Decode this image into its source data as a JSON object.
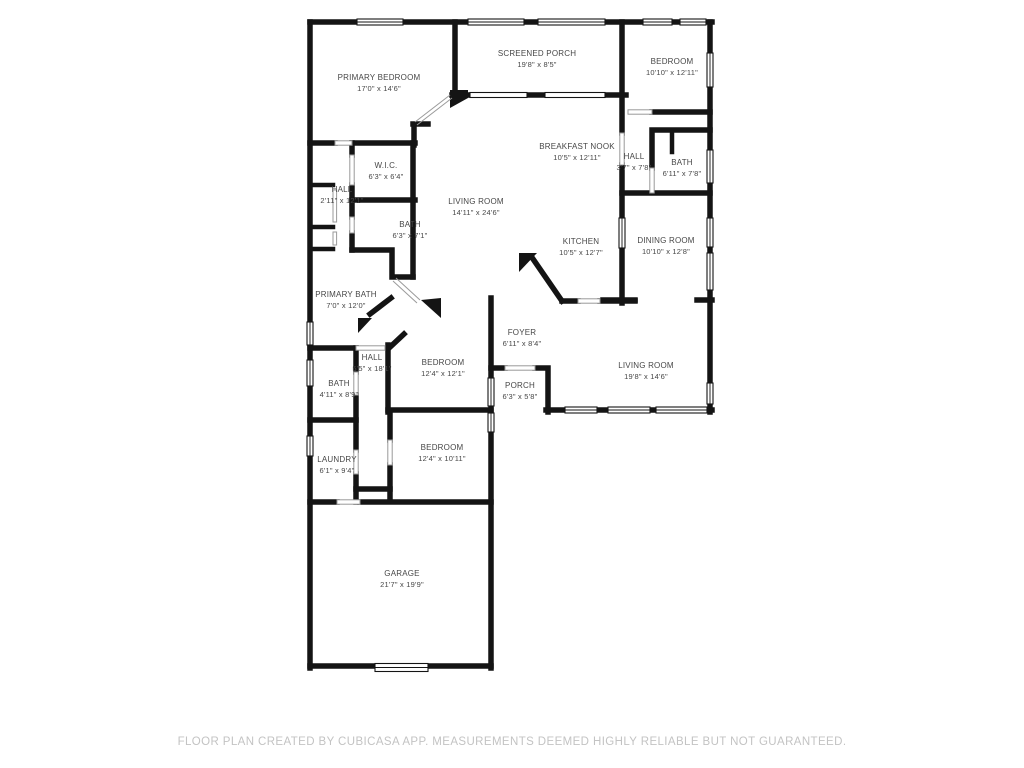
{
  "floor_plan": {
    "footer_disclaimer": "FLOOR PLAN CREATED BY CUBICASA APP. MEASUREMENTS DEEMED HIGHLY RELIABLE BUT NOT GUARANTEED.",
    "wall_color": "#141414",
    "label_color": "#474747",
    "footer_color": "#c3c3c3",
    "rooms": [
      {
        "name": "PRIMARY BEDROOM",
        "dimensions": "17'0\" x 14'6\"",
        "x": 379,
        "y": 83
      },
      {
        "name": "SCREENED PORCH",
        "dimensions": "19'8\" x 8'5\"",
        "x": 537,
        "y": 59
      },
      {
        "name": "BEDROOM",
        "dimensions": "10'10\" x 12'11\"",
        "x": 672,
        "y": 67
      },
      {
        "name": "W.I.C.",
        "dimensions": "6'3\" x 6'4\"",
        "x": 386,
        "y": 171
      },
      {
        "name": "HALL",
        "dimensions": "2'11\" x 12'1\"",
        "x": 342,
        "y": 195
      },
      {
        "name": "BREAKFAST NOOK",
        "dimensions": "10'5\" x 12'11\"",
        "x": 577,
        "y": 152
      },
      {
        "name": "HALL",
        "dimensions": "3'7\" x 7'8\"",
        "x": 634,
        "y": 162
      },
      {
        "name": "BATH",
        "dimensions": "6'11\" x 7'8\"",
        "x": 682,
        "y": 168
      },
      {
        "name": "LIVING ROOM",
        "dimensions": "14'11\" x 24'6\"",
        "x": 476,
        "y": 207
      },
      {
        "name": "BATH",
        "dimensions": "6'3\" x 7'1\"",
        "x": 410,
        "y": 230
      },
      {
        "name": "KITCHEN",
        "dimensions": "10'5\" x 12'7\"",
        "x": 581,
        "y": 247
      },
      {
        "name": "DINING ROOM",
        "dimensions": "10'10\" x 12'8\"",
        "x": 666,
        "y": 246
      },
      {
        "name": "PRIMARY BATH",
        "dimensions": "7'0\" x 12'0\"",
        "x": 346,
        "y": 300
      },
      {
        "name": "FOYER",
        "dimensions": "6'11\" x 8'4\"",
        "x": 522,
        "y": 338
      },
      {
        "name": "HALL",
        "dimensions": "5'5\" x 18'1\"",
        "x": 372,
        "y": 363
      },
      {
        "name": "BEDROOM",
        "dimensions": "12'4\" x 12'1\"",
        "x": 443,
        "y": 368
      },
      {
        "name": "LIVING ROOM",
        "dimensions": "19'8\" x 14'6\"",
        "x": 646,
        "y": 371
      },
      {
        "name": "BATH",
        "dimensions": "4'11\" x 8'9\"",
        "x": 339,
        "y": 389
      },
      {
        "name": "PORCH",
        "dimensions": "6'3\" x 5'8\"",
        "x": 520,
        "y": 391
      },
      {
        "name": "BEDROOM",
        "dimensions": "12'4\" x 10'11\"",
        "x": 442,
        "y": 453
      },
      {
        "name": "LAUNDRY",
        "dimensions": "6'1\" x 9'4\"",
        "x": 337,
        "y": 465
      },
      {
        "name": "GARAGE",
        "dimensions": "21'7\" x 19'9\"",
        "x": 402,
        "y": 579
      }
    ]
  }
}
